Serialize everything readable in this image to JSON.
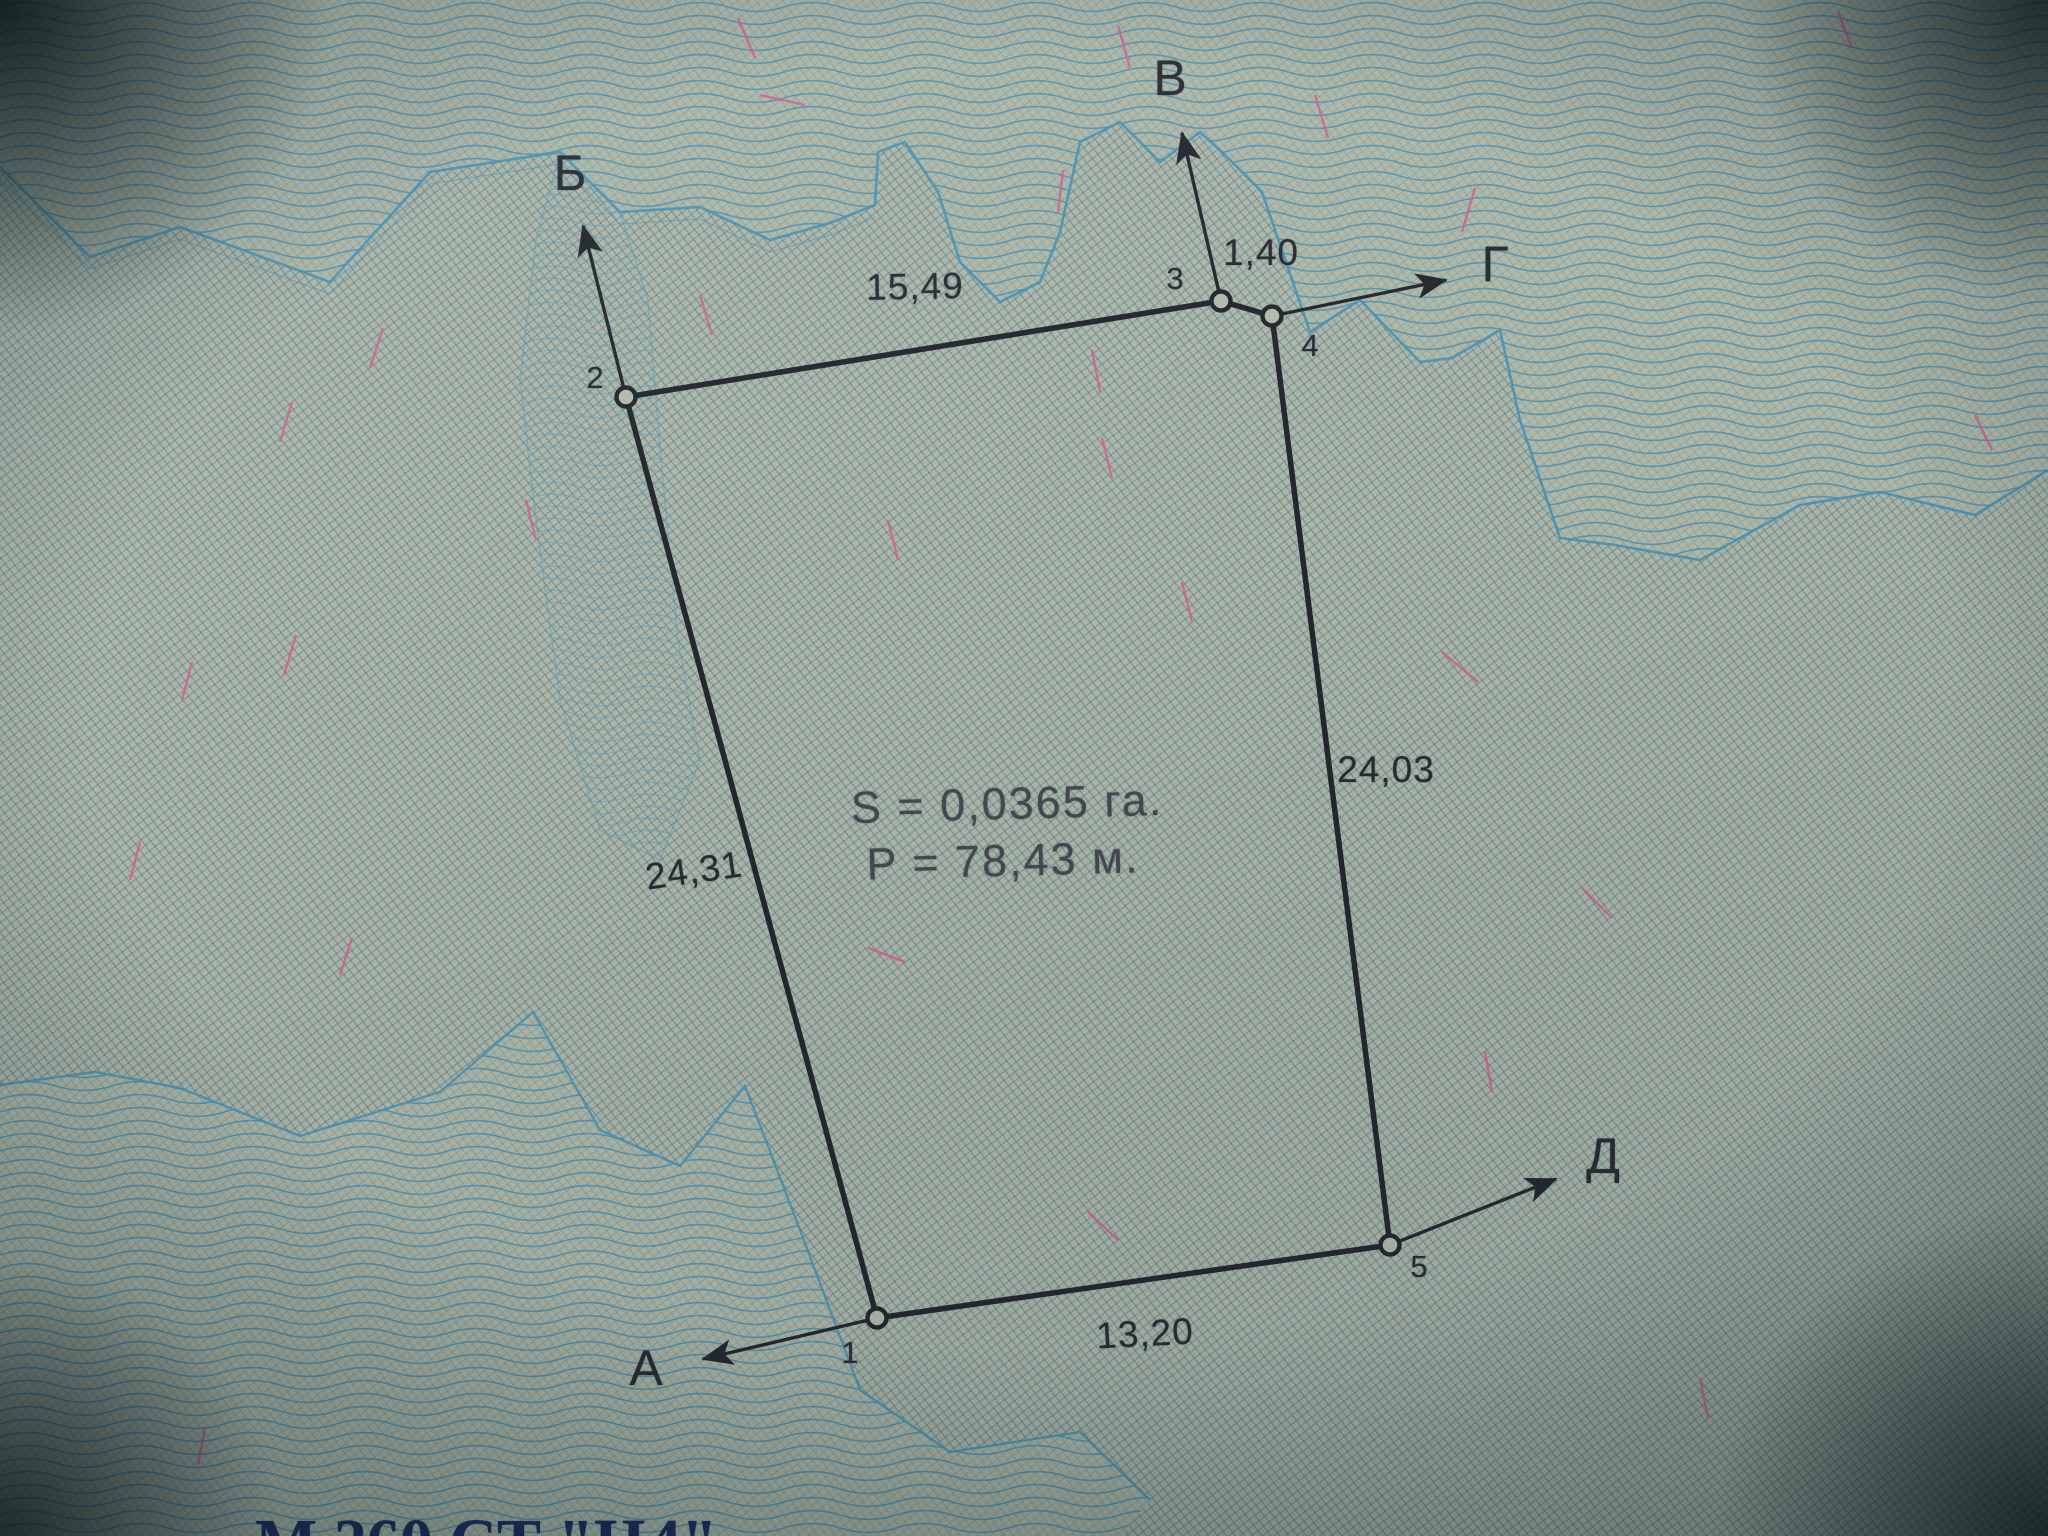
{
  "plan": {
    "summary": {
      "area_label": "S = 0,0365 га.",
      "perimeter_label": "P = 78,43 м."
    },
    "vertices": [
      {
        "id": "1"
      },
      {
        "id": "2"
      },
      {
        "id": "3"
      },
      {
        "id": "4"
      },
      {
        "id": "5"
      }
    ],
    "sides": [
      {
        "from": "1",
        "to": "2",
        "length": "24,31"
      },
      {
        "from": "2",
        "to": "3",
        "length": "15,49"
      },
      {
        "from": "3",
        "to": "4",
        "length": "1,40"
      },
      {
        "from": "4",
        "to": "5",
        "length": "24,03"
      },
      {
        "from": "5",
        "to": "1",
        "length": "13,20"
      }
    ],
    "directions": [
      {
        "label": "А",
        "from_vertex": "1"
      },
      {
        "label": "Б",
        "from_vertex": "2"
      },
      {
        "label": "В",
        "from_vertex": "3"
      },
      {
        "label": "Г",
        "from_vertex": "4"
      },
      {
        "label": "Д",
        "from_vertex": "5"
      }
    ],
    "footer": {
      "left_fragment": "М 260 СТ \"Н",
      "right_fragment": "4\""
    }
  }
}
